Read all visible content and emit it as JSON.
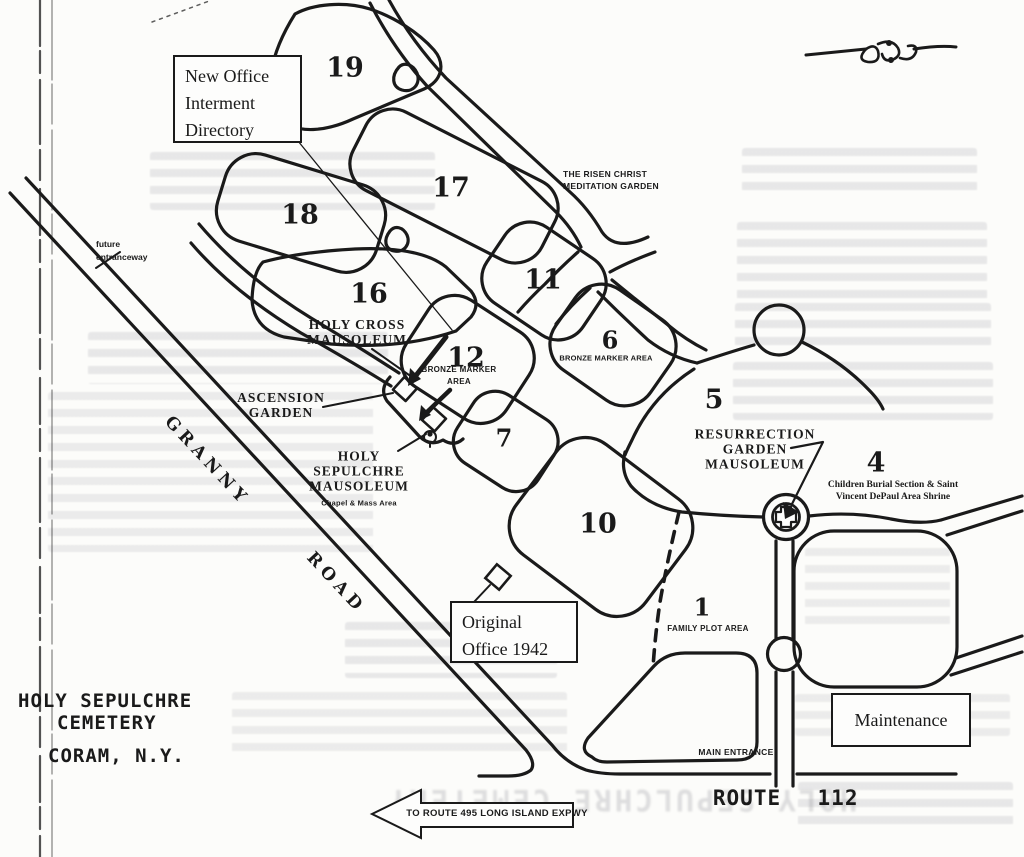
{
  "colors": {
    "ink": "#1a1a1a",
    "paper": "#fcfcfa"
  },
  "title": {
    "lines": [
      "HOLY SEPULCHRE",
      "CEMETERY",
      "CORAM, N.Y."
    ]
  },
  "boxes": {
    "new_office": {
      "lines": [
        "New Office",
        "Interment",
        "Directory"
      ]
    },
    "original_office": {
      "lines": [
        "Original",
        "Office 1942"
      ]
    },
    "maintenance": {
      "label": "Maintenance"
    }
  },
  "sections": {
    "s19": "19",
    "s18": "18",
    "s17": "17",
    "s16": "16",
    "s12": "12",
    "s11": "11",
    "s10": "10",
    "s7": "7",
    "s6": "6",
    "s5": "5",
    "s4": "4",
    "s1": "1"
  },
  "area_notes": {
    "bronze_marker_6": "BRONZE MARKER AREA",
    "bronze_marker_12": [
      "BRONZE MARKER",
      "AREA"
    ],
    "family_plot": "FAMILY PLOT AREA",
    "chapel_mass": "Chapel & Mass Area",
    "children_burial": [
      "Children Burial Section & Saint",
      "Vincent DePaul Area Shrine"
    ]
  },
  "labels": {
    "risen_christ": [
      "THE RISEN CHRIST",
      "MEDITATION GARDEN"
    ],
    "holy_cross": [
      "HOLY CROSS",
      "MAUSOLEUM"
    ],
    "ascension": [
      "ASCENSION",
      "GARDEN"
    ],
    "holy_sepulchre_mausoleum": [
      "HOLY",
      "SEPULCHRE",
      "MAUSOLEUM"
    ],
    "resurrection": [
      "RESURRECTION",
      "GARDEN",
      "MAUSOLEUM"
    ],
    "future_entranceway": [
      "future",
      "entranceway"
    ]
  },
  "roads": {
    "granny": "GRANNY",
    "road": "ROAD",
    "route": "ROUTE",
    "route_number": "112",
    "main_entrance": "MAIN ENTRANCE",
    "to_expressway": "TO ROUTE 495 LONG ISLAND EXPWY"
  },
  "icons": {
    "ornament": "flourish-divider-icon",
    "shrine": "shrine-cross-icon",
    "statue": "statue-icon",
    "arrow_left": "left-arrow-icon"
  },
  "scan_artifacts": {
    "bleedthrough_title": "HOLY SEPULCHRE CEMETERY"
  }
}
